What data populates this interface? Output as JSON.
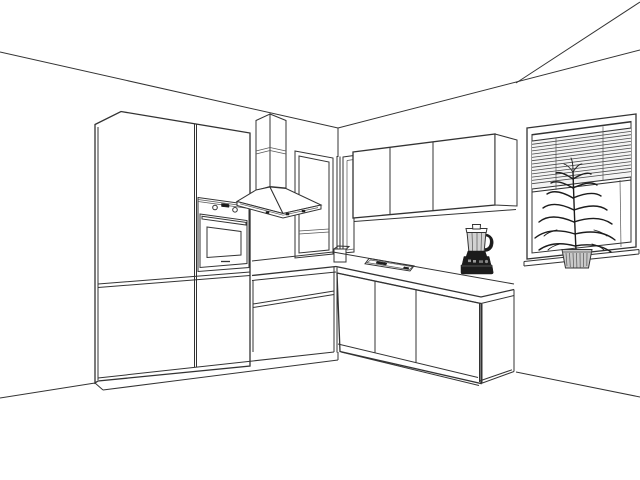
{
  "scene": {
    "title": "3D line-art perspective rendering of an L-shaped kitchen",
    "style": "black-and-white wireframe / hidden-line render",
    "room": {
      "walls_visible": [
        "left-wall",
        "right-wall"
      ],
      "ceiling_visible": true,
      "floor_visible": true,
      "corner_position": "upper-center of image"
    },
    "objects": [
      {
        "name": "tall-cabinet-unit",
        "wall": "left",
        "description": "full-height cabinet block with two door columns and built-in oven",
        "door_columns": 2
      },
      {
        "name": "built-in-oven",
        "wall": "left",
        "knobs": 2,
        "display": 1,
        "handle_bar": 1,
        "glass_door": true,
        "bottom_dash_mark": true
      },
      {
        "name": "range-hood",
        "wall": "left",
        "type": "pyramid chimney hood",
        "chimney_sections": 2,
        "control_marks": 3
      },
      {
        "name": "corner-window-left",
        "wall": "left",
        "partially_hidden_by": "range-hood"
      },
      {
        "name": "corner-post",
        "location": "room corner",
        "base_box_on_counter": true
      },
      {
        "name": "corner-window-right-sliver",
        "wall": "right",
        "partially_hidden_by": "upper-wall-cabinet"
      },
      {
        "name": "upper-wall-cabinet",
        "wall": "right",
        "doors": 3,
        "end_panel": "right"
      },
      {
        "name": "base-cabinet-run-left",
        "wall": "left",
        "drawer_fronts": 2
      },
      {
        "name": "base-cabinet-run-right",
        "wall": "right",
        "door_sections": 3,
        "end_panel": "right"
      },
      {
        "name": "countertop",
        "shape": "L-shaped",
        "color": "white"
      },
      {
        "name": "cooktop-inset",
        "location": "right counter near wall",
        "shape": "slim rectangle",
        "dark_marks": 2
      },
      {
        "name": "blender",
        "location": "right counter, back edge",
        "base_color_hex": "#1c1c1c",
        "jar_color_hex": "#d2d2d2",
        "has_handle": true,
        "buttons": 3
      },
      {
        "name": "window-with-blinds",
        "wall": "right",
        "venetian_blind": {
          "slat_count": 14,
          "lowered_fraction": "about 55%",
          "lift_cord": true,
          "ladder_cords": 2
        },
        "sill": true
      },
      {
        "name": "potted-plant",
        "location": "windowsill",
        "pot_style": "ribbed tapered pot",
        "leaf_pairs": 7
      }
    ]
  },
  "colors": {
    "line": "#333333",
    "background": "#ffffff",
    "blender_base": "#1c1c1c",
    "blender_jar": "#d2d2d2",
    "plant_pot": "#c9c9c9",
    "blind_fill": "#f4f4f4"
  },
  "counts": {
    "upper_cabinet_doors": 3,
    "oven_knobs": 2,
    "blind_slats": 14,
    "left_run_drawers": 2,
    "right_run_door_sections": 3
  }
}
